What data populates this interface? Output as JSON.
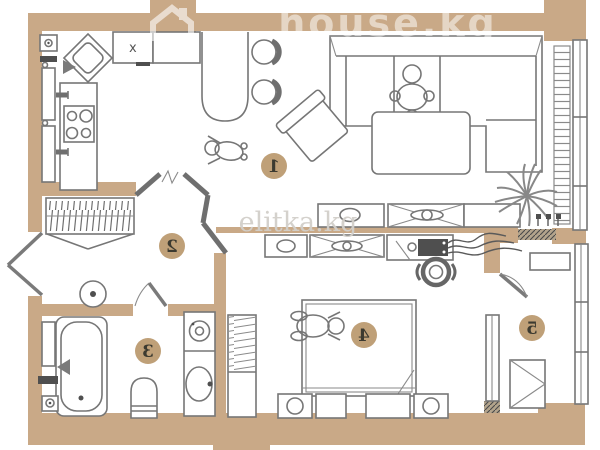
{
  "plan": {
    "watermark_primary": "house.kg",
    "watermark_secondary": "elitka.kg",
    "cabinet_mark": "x",
    "rooms": [
      {
        "label": "1"
      },
      {
        "label": "2"
      },
      {
        "label": "3"
      },
      {
        "label": "4"
      },
      {
        "label": "5"
      }
    ],
    "colors": {
      "wall": "#c9a987",
      "furniture_line": "#767676",
      "dark_fixture": "#4f4f4f",
      "label_circle": "#bfa078",
      "label_text": "#3c3a30",
      "watermark_primary": "#ffffff",
      "watermark_secondary": "#d2cfca",
      "background": "#ffffff"
    },
    "fixtures": {
      "kitchen": [
        "corner-sink-icon",
        "hob-4-burner-icon",
        "cabinet-x-icon",
        "bar-counter-icon",
        "bar-stool-icon",
        "bar-stool-icon",
        "vent-icon",
        "riser-radiator-icon",
        "riser-radiator-icon"
      ],
      "hallway": [
        "wardrobe-hangers-icon",
        "entrance-double-door-icon",
        "stool-icon"
      ],
      "bathroom": [
        "bathtub-icon",
        "toilet-icon",
        "washing-machine-icon",
        "washbasin-icon",
        "door-swing-icon"
      ],
      "living_room": [
        "corner-sofa-icon",
        "person-sitting-icon",
        "person-standing-icon",
        "armchair-icon",
        "coffee-table-icon",
        "tv-console-icon",
        "sideboard-icon",
        "plant-icon",
        "radiator-icon",
        "window-icon",
        "socket-icon"
      ],
      "bedroom": [
        "double-bed-icon",
        "person-lying-icon",
        "nightstand-icon",
        "ottoman-icon",
        "shelving-unit-icon",
        "tv-console-icon",
        "media-device-icon",
        "cables-icon",
        "fan-icon"
      ],
      "balcony": [
        "wardrobe-icon",
        "shelf-icon",
        "glazing-icon",
        "window-icon",
        "balcony-door-icon"
      ]
    }
  }
}
